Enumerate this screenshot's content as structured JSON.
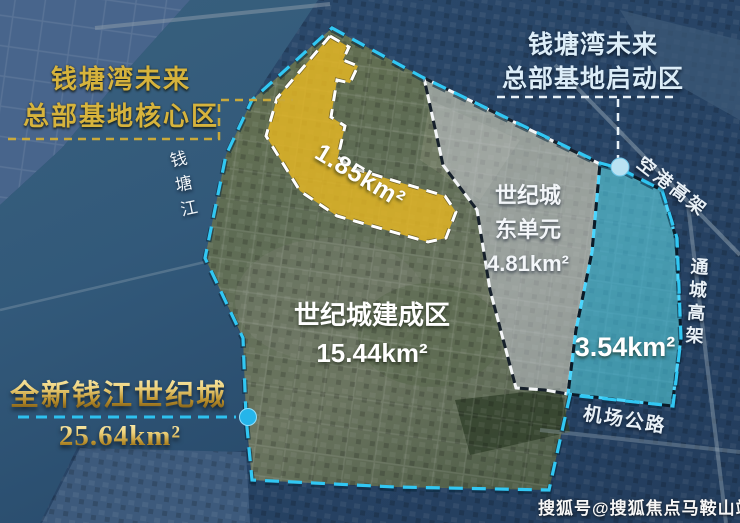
{
  "map": {
    "regions": {
      "core": {
        "title_line1": "钱塘湾未来",
        "title_line2": "总部基地核心区",
        "area": "1.85km²",
        "fill_color": "#e7b722"
      },
      "startup": {
        "title_line1": "钱塘湾未来",
        "title_line2": "总部基地启动区",
        "area": "3.54km²",
        "fill_color": "#35b4e4"
      },
      "east_unit": {
        "name_line1": "世纪城",
        "name_line2": "东单元",
        "area": "4.81km²",
        "fill_color": "#c7ccd6"
      },
      "builtup": {
        "name": "世纪城建成区",
        "area": "15.44km²"
      },
      "overall": {
        "name": "全新钱江世纪城",
        "area": "25.64km²",
        "boundary_color": "#31c7f3"
      }
    },
    "landmarks": {
      "river": "钱塘江",
      "road_airport_viaduct": "空港高架",
      "road_tongcheng_viaduct": "通城高架",
      "road_airport_highway": "机场公路"
    },
    "watermark": "搜狐号@搜狐焦点马鞍山站"
  }
}
